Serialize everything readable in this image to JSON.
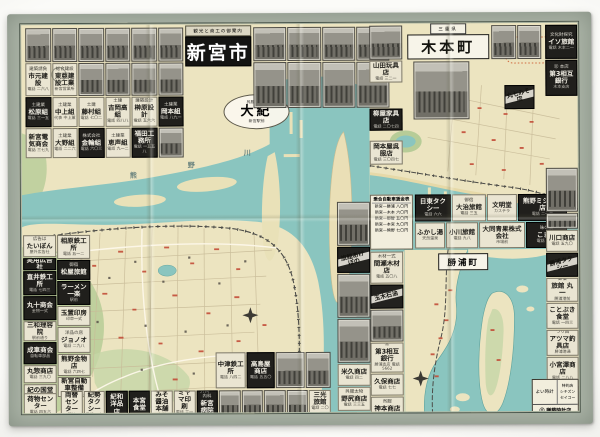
{
  "colors": {
    "paper": "#ece4c0",
    "water": "#8ac5bf",
    "green": "#b7cc97",
    "margin": "#aab3a6",
    "frame": "#46534b",
    "ad_dark": "#201f1c",
    "red_mark": "#c34d38"
  },
  "titles": {
    "shingu": {
      "kicker": "観光と商工の御案内",
      "main": "新宮市"
    },
    "kimoto": {
      "kicker": "三重県",
      "main": "木本町"
    },
    "katsuura": "勝浦町",
    "daiki": {
      "top": "呉服・洋品",
      "main": "大紀",
      "bottom": "新宮駅前"
    }
  },
  "map_labels": {
    "river_chars": [
      "熊",
      "野",
      "川"
    ]
  },
  "fare": {
    "title": "乗合自動車賃金表",
    "rows": "新宮—勝浦 八〇円\n新宮—木本 六〇円\n新宮—那智 五〇円\n新宮—本宮 九〇円\n新宮—熊野 七〇円"
  },
  "corner": {
    "left": "よい時計",
    "right": "特約店\nシチズン\nセイコー",
    "bottom": "㊂ 謙藤時計店"
  },
  "ads": {
    "top_row_left": [
      {
        "style": "photo"
      },
      {
        "style": "photo"
      },
      {
        "style": "photo"
      },
      {
        "style": "photo"
      },
      {
        "style": "photo"
      },
      {
        "style": "photo"
      }
    ],
    "top_row_right": [
      {
        "style": "photo"
      },
      {
        "style": "photo"
      },
      {
        "style": "photo"
      },
      {
        "style": "photo"
      }
    ],
    "row2": [
      {
        "style": "light",
        "kicker": "建築請負",
        "name": "市元建設",
        "sub": "電話 二六八"
      },
      {
        "style": "light",
        "kicker": "総合建設",
        "name": "東亜建設工業",
        "sub": "新宮営業所"
      },
      {
        "style": "photo"
      },
      {
        "style": "photo"
      },
      {
        "style": "photo"
      },
      {
        "style": "photo"
      }
    ],
    "row2_right": [
      {
        "style": "photo"
      },
      {
        "style": "photo"
      },
      {
        "style": "photo"
      },
      {
        "style": "photo"
      }
    ],
    "row3": [
      {
        "style": "dark",
        "kicker": "土建業",
        "name": "松原組",
        "sub": "電話 三一五"
      },
      {
        "style": "light",
        "kicker": "土建業",
        "name": "中上組",
        "sub": "代表 中上薫"
      },
      {
        "style": "light",
        "kicker": "土建",
        "name": "藤村組",
        "sub": "電話 七〇二"
      },
      {
        "style": "light",
        "kicker": "土建",
        "name": "吉岡高組",
        "sub": "電話 四八八"
      },
      {
        "style": "light",
        "kicker": "建築設計",
        "name": "榊原設計",
        "sub": "電話 五六六"
      },
      {
        "style": "dark",
        "kicker": "土建業",
        "name": "岡本組",
        "sub": "電話 八九一"
      }
    ],
    "row4": [
      {
        "style": "light",
        "name": "新宮電気商会",
        "sub": "電話 三七九"
      },
      {
        "style": "light",
        "kicker": "土建業",
        "name": "大野組",
        "sub": "電話 二二六"
      },
      {
        "style": "dark",
        "kicker": "株式会社",
        "name": "金輪組",
        "sub": "電話 六〇三"
      },
      {
        "style": "light",
        "kicker": "土建業",
        "name": "恵声組",
        "sub": "電話 九一二"
      },
      {
        "style": "dark",
        "name": "福田工務所",
        "sub": "電話 一五五八"
      },
      {
        "style": "photo"
      }
    ],
    "left_col_a": [
      {
        "style": "light",
        "cls": "h22",
        "kicker": "広告は",
        "name": "たいぼん",
        "sub": "屋外広告社"
      },
      {
        "style": "dark",
        "cls": "h12",
        "name": "実用広告社"
      },
      {
        "style": "dark",
        "cls": "h24",
        "name": "直井鉄工所",
        "sub": "電話 七四三"
      },
      {
        "style": "dark",
        "cls": "h24",
        "name": "丸十商会",
        "sub": "金物一式"
      },
      {
        "style": "light",
        "cls": "h20",
        "name": "三和理容院",
        "sub": "駅前通り"
      },
      {
        "style": "dark",
        "cls": "h22",
        "name": "成車商会",
        "sub": "自転車部品"
      },
      {
        "style": "light",
        "cls": "h18",
        "name": "丸惣商店",
        "sub": "電話 三九〇"
      },
      {
        "style": "light",
        "cls": "h14",
        "name": "紀の国堂"
      }
    ],
    "left_col_b": [
      {
        "style": "light",
        "cls": "h24",
        "name": "相原鉄工所",
        "sub": "電話 五一二"
      },
      {
        "style": "dark",
        "cls": "h20",
        "kicker": "御宿",
        "name": "松屋旅館"
      },
      {
        "style": "dark",
        "cls": "h24",
        "name": "ラーメン一楽",
        "sub": "駅前"
      },
      {
        "style": "light",
        "cls": "h20",
        "name": "玉置印房",
        "sub": "印章一式"
      },
      {
        "style": "light",
        "cls": "h26",
        "kicker": "洋品の店",
        "name": "ジョノオ",
        "sub": "電話 二九八"
      },
      {
        "style": "light",
        "cls": "h22",
        "name": "熊野金物店",
        "sub": "電話 六四七"
      },
      {
        "style": "light",
        "cls": "h20",
        "name": "新宮自動車整備",
        "sub": "電話 一〇八八"
      }
    ],
    "corner_bl": [
      {
        "style": "light",
        "cls": "h24",
        "name": "荷物センター",
        "sub": "電話 四五六"
      }
    ],
    "bottom_cluster": [
      {
        "style": "light",
        "name": "中津鉄工所",
        "sub": "電話 八四二"
      },
      {
        "style": "dark",
        "name": "高島屋商店",
        "sub": "電話 五五〇"
      },
      {
        "style": "photo"
      },
      {
        "style": "photo"
      }
    ],
    "bottom_row": [
      {
        "style": "light",
        "name": "両替センター",
        "sub": "駅前"
      },
      {
        "style": "light",
        "name": "紀勢タクシー",
        "sub": "電話 一六"
      },
      {
        "style": "dark",
        "name": "紀和洋品店"
      },
      {
        "style": "dark",
        "name": "本宮食堂"
      },
      {
        "style": "light",
        "name": "みそ醤油本舗",
        "sub": "丸新"
      },
      {
        "style": "light",
        "name": "ミヤマ印刷",
        "sub": "電話 三一〇"
      },
      {
        "style": "dark",
        "kicker": "外科・内科",
        "name": "新宮病院",
        "sub": "電話 六八"
      },
      {
        "style": "photo"
      },
      {
        "style": "photo"
      },
      {
        "style": "photo"
      },
      {
        "style": "photo"
      },
      {
        "style": "light",
        "name": "三光旅館",
        "sub": "電話 二〇一"
      }
    ],
    "mid_strip_left": [
      {
        "style": "photo",
        "cls": "h44"
      },
      {
        "style": "diag",
        "cls": "h26",
        "name": "旅館あけぼの"
      },
      {
        "style": "photo",
        "cls": "h44"
      },
      {
        "style": "photo",
        "cls": "h44"
      },
      {
        "style": "light",
        "cls": "h22",
        "name": "米久商店",
        "sub": "電話 四二"
      },
      {
        "style": "light",
        "cls": "h24",
        "kicker": "呉服太物",
        "name": "野尻商店",
        "sub": "電話 三三五"
      },
      {
        "style": "light big",
        "cls": "h20",
        "name": "カバン",
        "sub": "新宮鞄店"
      },
      {
        "style": "light",
        "cls": "h12",
        "name": "丸善ミシン商会"
      }
    ],
    "mid_strip_right": [
      {
        "style": "light",
        "cls": "h32",
        "kicker": "木材一式",
        "name": "間瀬木材店",
        "sub": "電話 五〇八"
      },
      {
        "style": "diag",
        "cls": "h24",
        "name": "玉木石油"
      },
      {
        "style": "photo",
        "cls": "h32"
      },
      {
        "style": "light",
        "cls": "h30",
        "kicker": "㊂",
        "name": "第3相互銀行",
        "sub": "勝浦支店 電話5662"
      },
      {
        "style": "light",
        "cls": "h22",
        "name": "久保商店",
        "sub": "電話 七七"
      },
      {
        "style": "light",
        "cls": "h24",
        "kicker": "呉服",
        "name": "神本商店",
        "sub": "電話 四七五"
      },
      {
        "style": "dark",
        "cls": "h22",
        "name": "時計・メガネ",
        "sub": "宝飾堂"
      }
    ],
    "mid_band_r1": [
      {
        "style": "dark",
        "name": "日東タクシー",
        "sub": "電話 六六"
      },
      {
        "style": "light",
        "kicker": "御宿",
        "name": "大治旅館",
        "sub": "電話 三五"
      },
      {
        "style": "light",
        "name": "文明堂",
        "sub": "カステラ"
      },
      {
        "style": "dark",
        "name": "熊野ミシン商店",
        "sub": "電話 二一三"
      }
    ],
    "mid_band_r2": [
      {
        "style": "light",
        "name": "ふかし湯",
        "sub": "天然温泉"
      },
      {
        "style": "light",
        "name": "小川旅館",
        "sub": "電話 九八"
      },
      {
        "style": "light",
        "name": "大同青果株式会社",
        "sub": "市場前"
      },
      {
        "style": "dark",
        "kicker": "味の店",
        "name": "こまや",
        "sub": "電話 第1號"
      }
    ],
    "kimoto_left_stack": [
      {
        "style": "photo",
        "cls": "h34"
      },
      {
        "style": "light",
        "cls": "h22",
        "name": "山田玩具店",
        "sub": "電話 三二一"
      },
      {
        "style": "gap",
        "cls": "h24"
      },
      {
        "style": "dark",
        "cls": "h22",
        "name": "柳屋家具店",
        "sub": "電話 二〇七四"
      },
      {
        "style": "gap",
        "cls": "h8"
      },
      {
        "style": "light",
        "cls": "h24",
        "name": "岡本屋呉服店",
        "sub": "電話 三〇四七"
      }
    ],
    "kimoto_photos_right": [
      {
        "style": "photo"
      },
      {
        "style": "photo"
      }
    ],
    "kimoto_diag": [
      {
        "style": "diag",
        "cls": "h24",
        "name": "丸七みそ店"
      }
    ],
    "right_col": [
      {
        "style": "dark",
        "cls": "h34",
        "kicker": "文化財探究",
        "name": "イソ旅館",
        "sub": "電話 木本二一"
      },
      {
        "style": "dark",
        "cls": "h36",
        "kicker": "㊂ 本店",
        "name": "第3相互銀行",
        "sub": "木本支店"
      },
      {
        "style": "gap",
        "cls": "h70"
      },
      {
        "style": "photo",
        "cls": "h44"
      },
      {
        "style": "photo",
        "cls": "h16"
      },
      {
        "style": "light",
        "cls": "h22",
        "name": "川口商店",
        "sub": "電話 五九〇"
      },
      {
        "style": "diag",
        "cls": "h24",
        "name": "勝浦タクシー"
      },
      {
        "style": "light",
        "cls": "h24",
        "kicker": "御宿",
        "name": "旅館 丸一",
        "sub": "勝浦港前"
      },
      {
        "style": "light",
        "cls": "h26",
        "name": "ことぶき食堂",
        "sub": "電話 一四三"
      },
      {
        "style": "light",
        "cls": "h26",
        "kicker": "つり具",
        "name": "アツマ釣具店",
        "sub": "勝浦港通"
      },
      {
        "style": "light",
        "cls": "h28",
        "name": "小宮澤商店",
        "sub": "電話 二八八"
      },
      {
        "style": "photo",
        "cls": "h20"
      }
    ]
  }
}
